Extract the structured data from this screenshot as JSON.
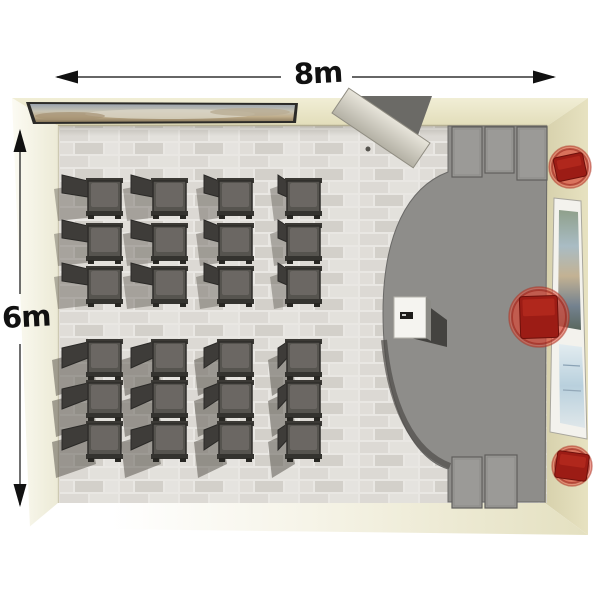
{
  "dimensions": {
    "width_label": "8m",
    "height_label": "6m"
  },
  "colors": {
    "background": "#ffffff",
    "wall_top": "#e9e5c7",
    "wall_right": "#ded9b7",
    "wall_left": "#f6f4e5",
    "floor": "#e7e5e1",
    "stage": "#8e8d8a",
    "cabinet": "#9b9a97",
    "chair_seat": "#56544f",
    "chair_cushion": "#6e6b66",
    "red_seat": "#9c1c15",
    "red_halo": "rgba(224,84,66,0.55)",
    "dimension_line": "#222222"
  },
  "seating": {
    "total_chairs": 24,
    "columns": 4,
    "rows": 6,
    "seat_size": 33,
    "columns_x": [
      88,
      153,
      219,
      287
    ],
    "back_widths": [
      26,
      22,
      15,
      9
    ],
    "top_rows_y": [
      181,
      226,
      269
    ],
    "bottom_rows_y": [
      342,
      383,
      424
    ]
  },
  "objects": {
    "stools": [
      {
        "name": "red-stool-top",
        "cx": 570,
        "cy": 167,
        "r": 21,
        "w": 30,
        "h": 24,
        "rot": -12
      },
      {
        "name": "red-presenter-chair",
        "cx": 539,
        "cy": 317,
        "r": 30,
        "w": 38,
        "h": 42,
        "rot": -2
      },
      {
        "name": "red-stool-bottom",
        "cx": 572,
        "cy": 466,
        "r": 20,
        "w": 32,
        "h": 27,
        "rot": 8
      }
    ],
    "stage_cabinets": [
      {
        "x": 452,
        "y": 127,
        "w": 30,
        "h": 50
      },
      {
        "x": 485,
        "y": 127,
        "w": 29,
        "h": 46
      },
      {
        "x": 517,
        "y": 127,
        "w": 30,
        "h": 53
      },
      {
        "x": 452,
        "y": 457,
        "w": 30,
        "h": 51
      },
      {
        "x": 485,
        "y": 455,
        "w": 32,
        "h": 53
      }
    ]
  }
}
